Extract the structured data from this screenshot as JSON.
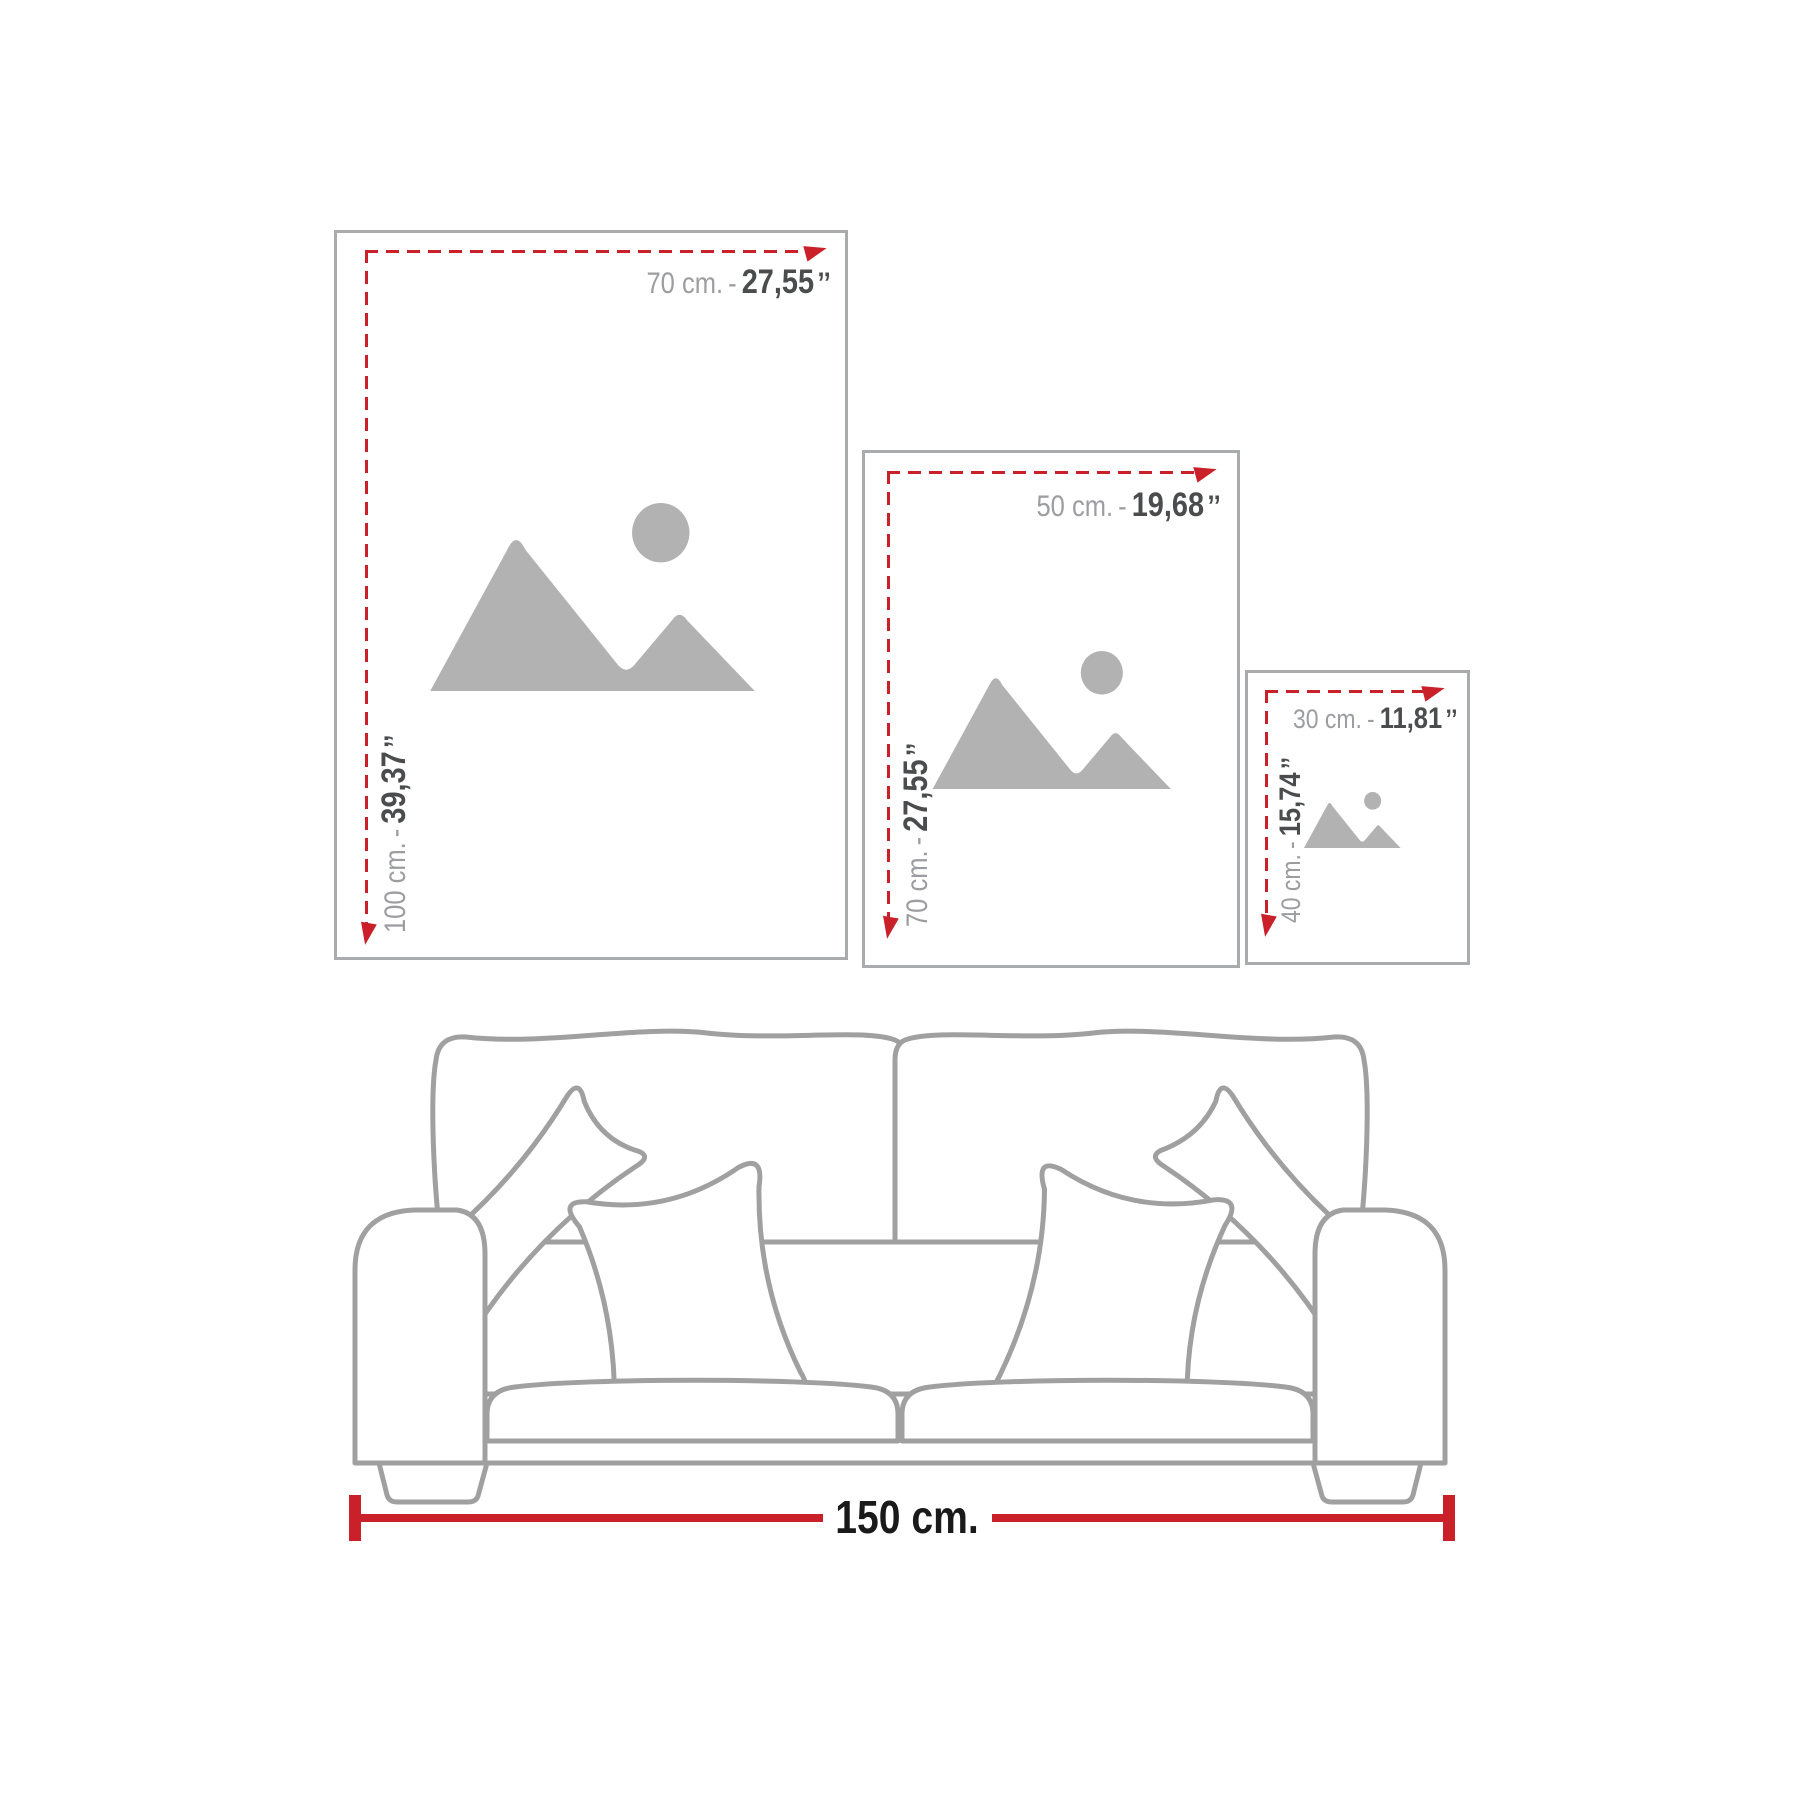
{
  "title": "Wall art size guide with sofa scale reference",
  "colors": {
    "red_accent": "#c9202a",
    "metric_text_gray": "#9c9da0",
    "imperial_text_dark": "#4b4c4e",
    "frame_border_gray": "#a9abad",
    "placeholder_icon_gray": "#b2b2b2",
    "sofa_outline_gray": "#a0a0a0",
    "sofa_width_text_black": "#1a1a1a"
  },
  "frames": [
    {
      "name": "poster-70x100",
      "width_label": {
        "metric": "70 cm.",
        "separator": "-",
        "imperial": "27,55",
        "unit_mark": "’’"
      },
      "height_label": {
        "metric": "100 cm.",
        "separator": "-",
        "imperial": "39,37",
        "unit_mark": "’’"
      }
    },
    {
      "name": "poster-50x70",
      "width_label": {
        "metric": "50 cm.",
        "separator": "-",
        "imperial": "19,68",
        "unit_mark": "’’"
      },
      "height_label": {
        "metric": "70 cm.",
        "separator": "-",
        "imperial": "27,55",
        "unit_mark": "’’"
      }
    },
    {
      "name": "poster-30x40",
      "width_label": {
        "metric": "30 cm.",
        "separator": "-",
        "imperial": "11,81",
        "unit_mark": "’’"
      },
      "height_label": {
        "metric": "40 cm.",
        "separator": "-",
        "imperial": "15,74",
        "unit_mark": "’’"
      }
    }
  ],
  "sofa": {
    "width_label": "150 cm."
  }
}
